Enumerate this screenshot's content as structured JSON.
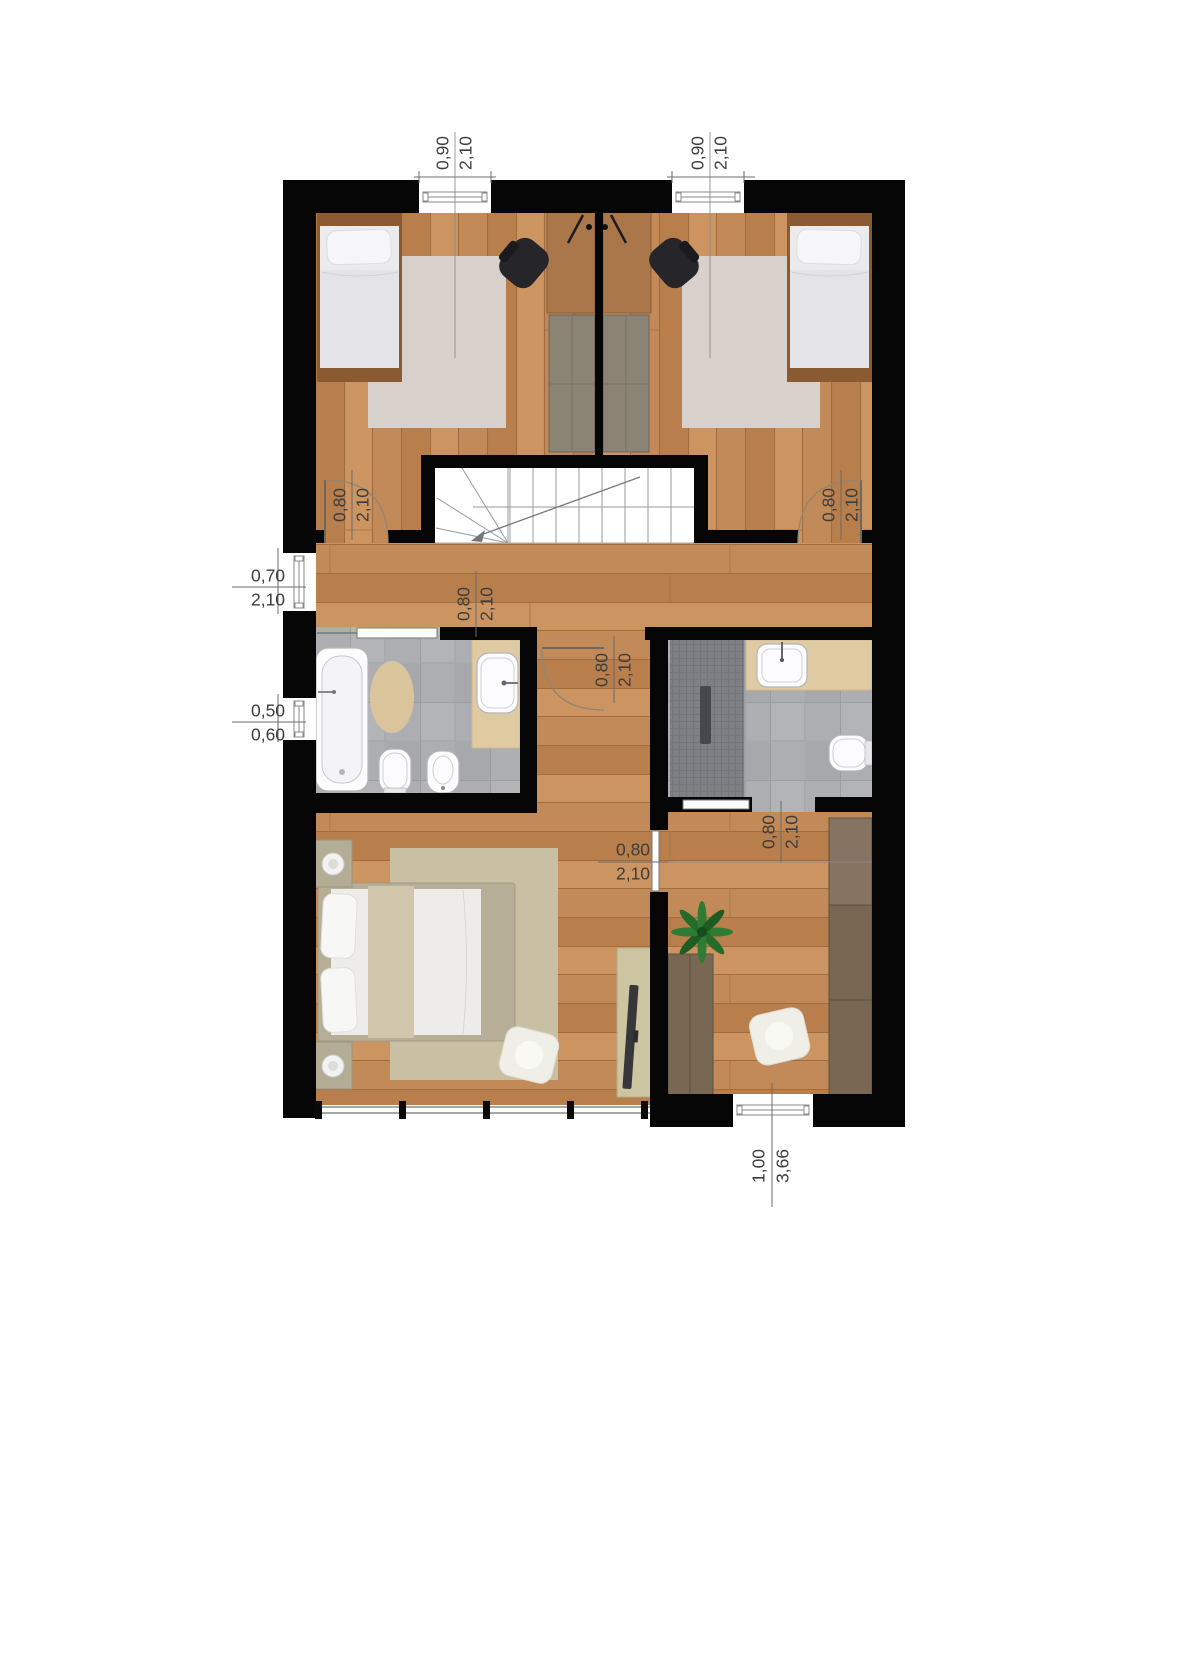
{
  "dimensions": {
    "window_top_left": {
      "width": "0,90",
      "height": "2,10"
    },
    "window_top_right": {
      "width": "0,90",
      "height": "2,10"
    },
    "door_bedroom_left": {
      "width": "0,80",
      "height": "2,10"
    },
    "door_bedroom_right": {
      "width": "0,80",
      "height": "2,10"
    },
    "door_hall_west": {
      "width": "0,70",
      "height": "2,10"
    },
    "window_bath_west": {
      "width": "0,50",
      "height": "0,60"
    },
    "door_bath_left": {
      "width": "0,80",
      "height": "2,10"
    },
    "door_corridor": {
      "width": "0,80",
      "height": "2,10"
    },
    "door_bath_right": {
      "width": "0,80",
      "height": "2,10"
    },
    "door_master_room": {
      "width": "0,80",
      "height": "2,10"
    },
    "window_south": {
      "width": "1,00",
      "height": "3,66"
    }
  },
  "colors": {
    "wall": "#060606",
    "wood_floor": "#c28a58",
    "bath_tile": "#adaeb2",
    "shower_tile": "#7e8085",
    "counter": "#dfcaa2",
    "rug_bedroom": "#d8d0cb",
    "rug_master": "#c9c0a4",
    "bath_rug": "#d9c49c",
    "desk_wood": "#a9774a",
    "wardrobe_dark": "#776753",
    "wardrobe_gray": "#8b8374",
    "plant_green": "#2e7c33",
    "dimension_text": "#3d3d3d"
  }
}
